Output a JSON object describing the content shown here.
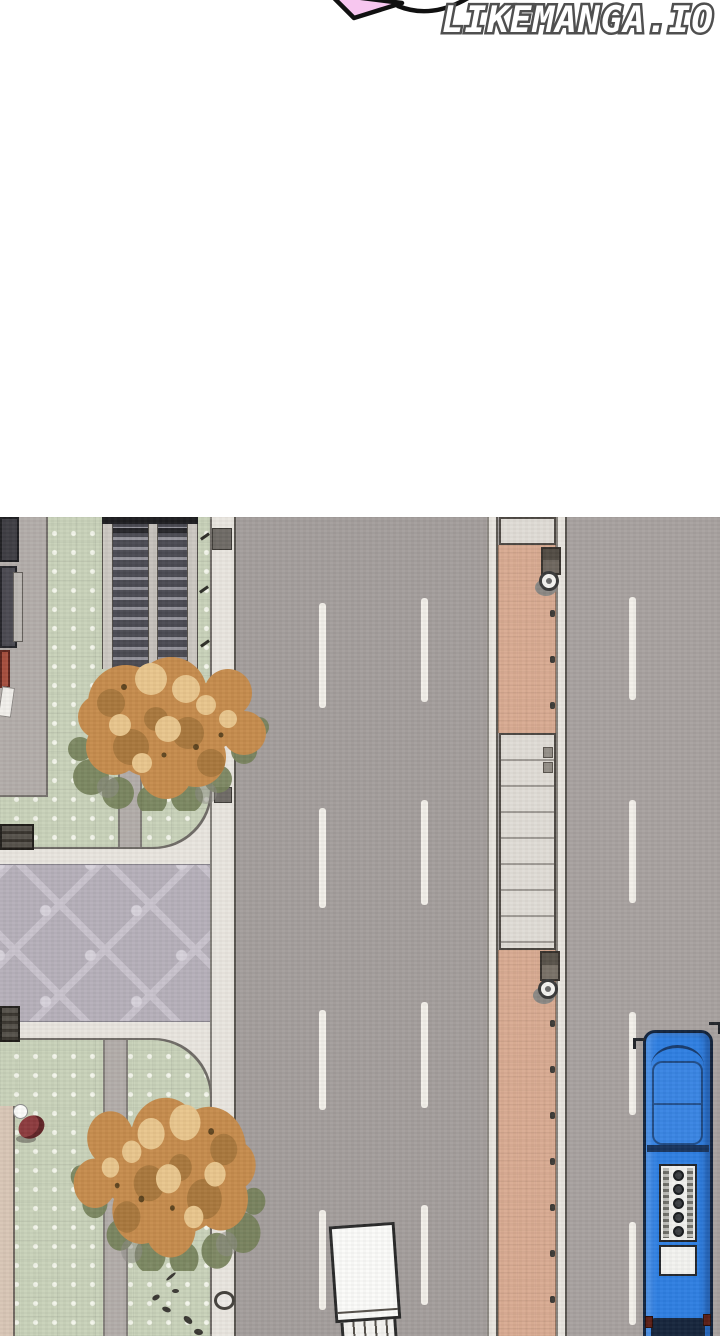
{
  "watermark": {
    "text": "LIKEMANGA.IO"
  },
  "speech_bubble": {
    "shape": "tail-tip",
    "fill": "#f7c6ef",
    "outline": "#111111"
  },
  "scene": {
    "description_name": "top-down-street-scene",
    "objects": {
      "bus": {
        "color": "#2f7fe2",
        "roof_vent_count": 5
      },
      "truck": {
        "color": "#fbfbf9"
      },
      "trees": {
        "count": 2,
        "season": "autumn"
      },
      "road": {
        "lane_dash_columns": 3,
        "dashes_per_column": 4
      },
      "median": {
        "bollard_count_lower": 7,
        "bollard_count_upper": 3
      },
      "stairs": {
        "flights": 2
      },
      "benches": {
        "count": 2
      },
      "pedestrians": {
        "count": 1
      }
    }
  },
  "palette": {
    "road": "#a49e9c",
    "road_right": "#a8a2a0",
    "dash": "#f3f0ea",
    "curb": "#e9e5df",
    "green": "#c9d2ba",
    "green_dot": "#f4f6ec",
    "gray_pav": "#b3adaa",
    "plaza": "#b6b0ba",
    "plaza_line": "#c9c3cd",
    "plaza_accent": "#d7d2db",
    "median_pink": "#d9ab92",
    "ramp": "#e0dcd6",
    "bus_blue": "#2f7fe2",
    "truck_white": "#fbfbf9",
    "tree_base": "#c68c4d",
    "tree_dark": "#a5763c",
    "tree_light": "#e9c68d",
    "tree_olive": "#75815a",
    "person_red": "#8d3b3e"
  }
}
